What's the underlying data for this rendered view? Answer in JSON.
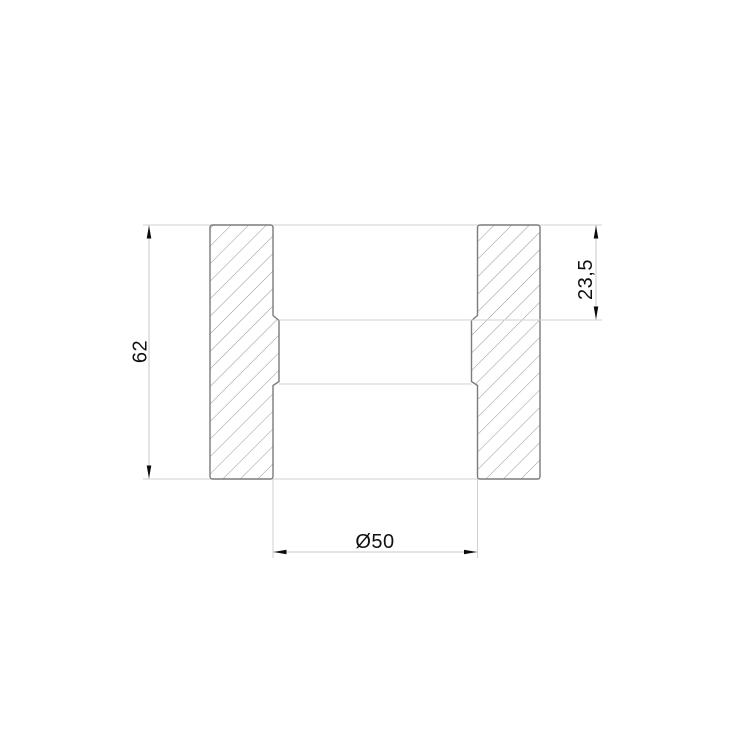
{
  "drawing": {
    "kind_label": "section view of a pipe coupling",
    "dimensions": {
      "overall_height": {
        "label": "62"
      },
      "socket_depth": {
        "label": "23,5"
      },
      "bore_diameter": {
        "label": "Ø50"
      }
    },
    "colors": {
      "background": "#ffffff",
      "section_outline": "#7b7b7b",
      "hatch": "#949494",
      "thin_lines": "#cfd2d4",
      "arrows_and_text": "#0c0c0c"
    }
  }
}
